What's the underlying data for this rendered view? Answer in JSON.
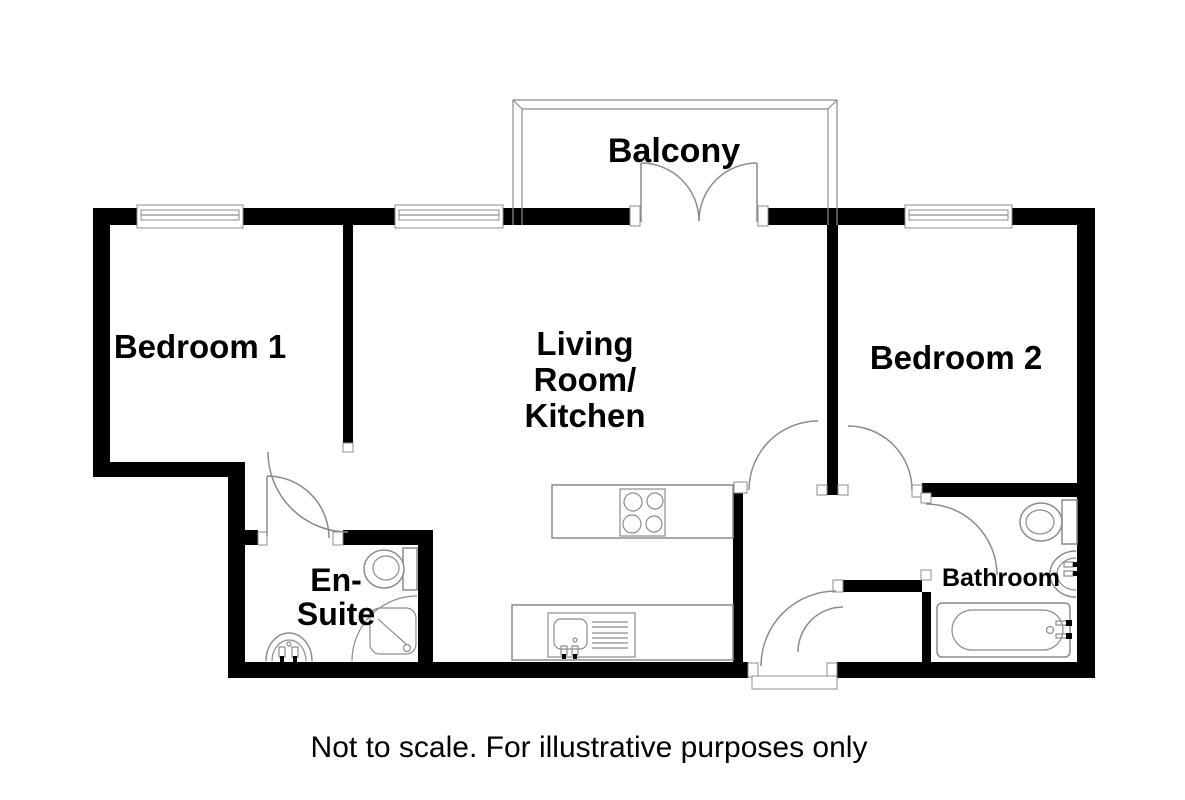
{
  "colors": {
    "background": "#ffffff",
    "wall": "#000000",
    "line": "#8c8c8c",
    "text": "#000000"
  },
  "rooms": {
    "balcony": {
      "label": "Balcony"
    },
    "bedroom1": {
      "label": "Bedroom 1"
    },
    "living_kitchen": {
      "label_lines": [
        "Living",
        "Room/",
        "Kitchen"
      ]
    },
    "bedroom2": {
      "label": "Bedroom 2"
    },
    "ensuite": {
      "label_lines": [
        "En-",
        "Suite"
      ]
    },
    "bathroom": {
      "label": "Bathroom"
    }
  },
  "fixtures": {
    "kitchen": [
      "hob",
      "sink-drainer"
    ],
    "ensuite": [
      "toilet",
      "corner-shower",
      "pedestal-basin"
    ],
    "bathroom": [
      "toilet",
      "pedestal-basin",
      "bathtub"
    ]
  },
  "footer": {
    "disclaimer": "Not to scale. For illustrative purposes only"
  }
}
